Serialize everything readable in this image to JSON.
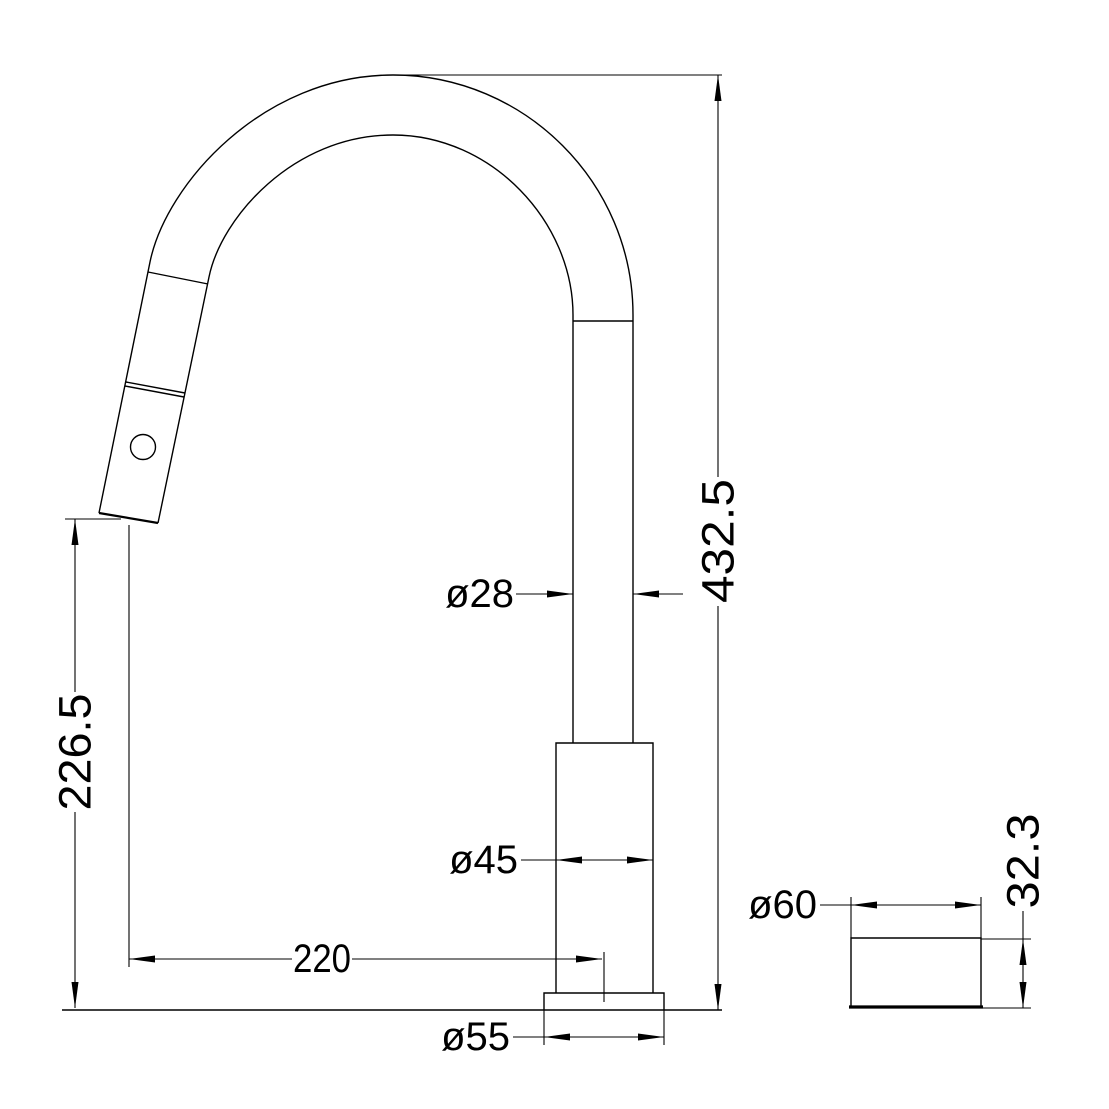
{
  "drawing": {
    "background_color": "#ffffff",
    "line_color": "#000000",
    "diameter_symbol": "ø",
    "dimensions": {
      "total_height": "432.5",
      "outlet_height": "226.5",
      "reach": "220",
      "tube_diameter": "ø28",
      "body_diameter": "ø45",
      "base_diameter": "ø55",
      "flange_diameter": "ø60",
      "flange_height": "32.3"
    }
  }
}
